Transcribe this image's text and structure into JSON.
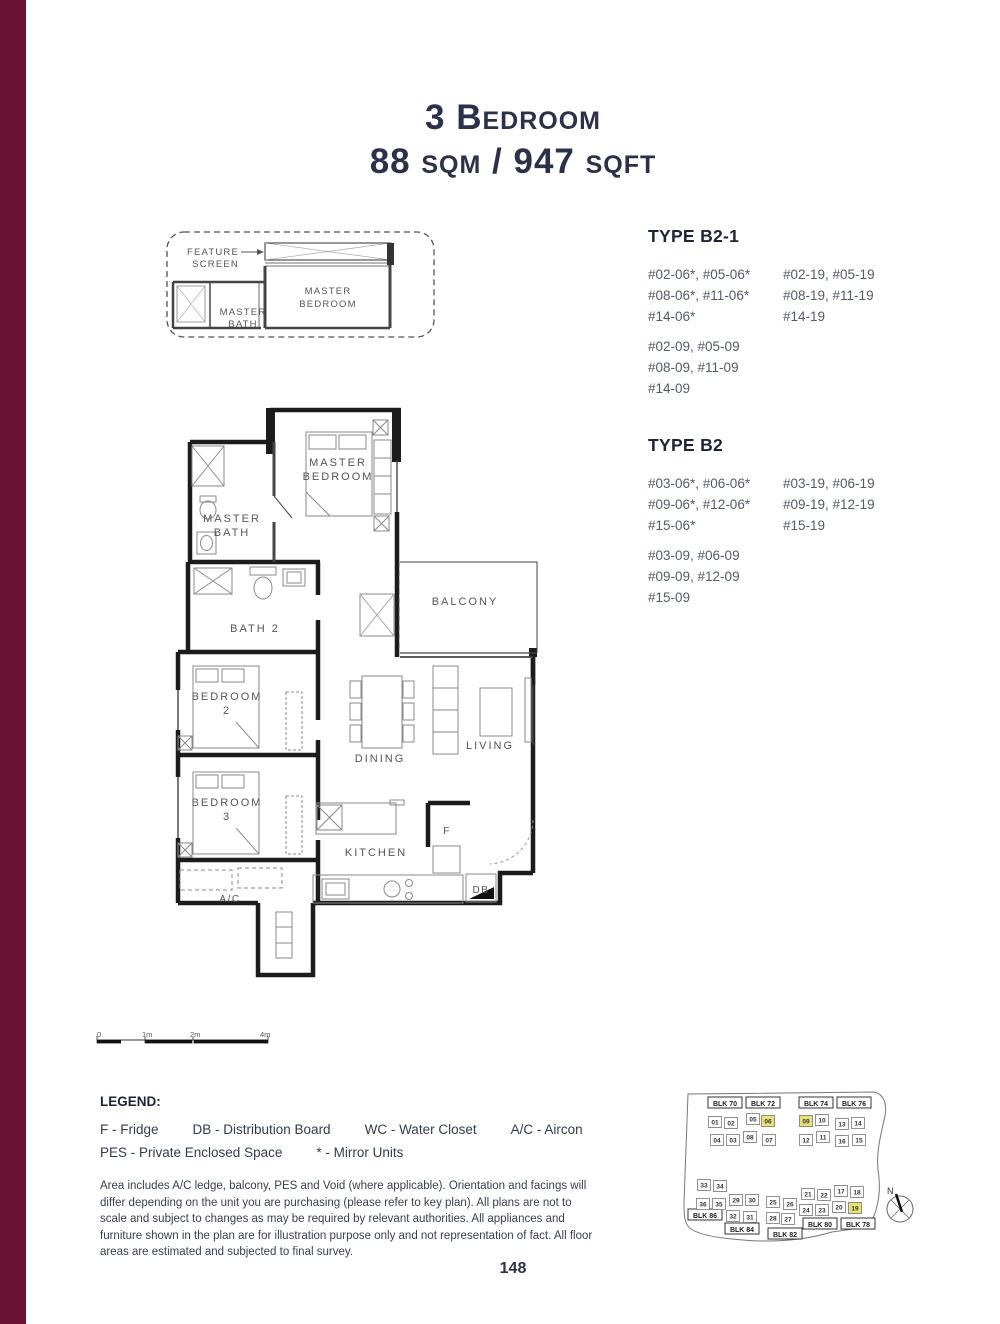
{
  "page": {
    "number": "148",
    "accent_color": "#6B1131",
    "highlight_color": "#e9e27a"
  },
  "title": {
    "line1": "3 Bedroom",
    "line2": "88 sqm / 947 sqft"
  },
  "types": [
    {
      "name": "TYPE B2-1",
      "c1a": [
        "#02-06*, #05-06*",
        "#08-06*, #11-06*",
        "#14-06*"
      ],
      "c2": [
        "#02-19, #05-19",
        "#08-19, #11-19",
        "#14-19"
      ],
      "c1b": [
        "#02-09, #05-09",
        "#08-09, #11-09",
        "#14-09"
      ]
    },
    {
      "name": "TYPE B2",
      "c1a": [
        "#03-06*, #06-06*",
        "#09-06*, #12-06*",
        "#15-06*"
      ],
      "c2": [
        "#03-19, #06-19",
        "#09-19, #12-19",
        "#15-19"
      ],
      "c1b": [
        "#03-09, #06-09",
        "#09-09, #12-09",
        "#15-09"
      ]
    }
  ],
  "inset": {
    "feature_screen_l1": "FEATURE",
    "feature_screen_l2": "SCREEN",
    "master_bedroom_l1": "MASTER",
    "master_bedroom_l2": "BEDROOM",
    "master_bath_l1": "MASTER",
    "master_bath_l2": "BATH"
  },
  "floorplan": {
    "master_bedroom_l1": "MASTER",
    "master_bedroom_l2": "BEDROOM",
    "master_bath_l1": "MASTER",
    "master_bath_l2": "BATH",
    "bath2": "BATH 2",
    "balcony": "BALCONY",
    "bedroom2_l1": "BEDROOM",
    "bedroom2_l2": "2",
    "bedroom3_l1": "BEDROOM",
    "bedroom3_l2": "3",
    "dining": "DINING",
    "living": "LIVING",
    "kitchen": "KITCHEN",
    "ac": "A/C",
    "fridge": "F",
    "db": "DB"
  },
  "scalebar": {
    "t0": "0",
    "t1": "1m",
    "t2": "2m",
    "t4": "4m"
  },
  "legend": {
    "title": "LEGEND:",
    "row1": [
      "F - Fridge",
      "DB - Distribution Board",
      "WC - Water Closet",
      "A/C - Aircon"
    ],
    "row2": [
      "PES - Private Enclosed Space",
      "* - Mirror Units"
    ]
  },
  "disclaimer": "Area includes A/C ledge, balcony, PES and Void (where applicable). Orientation and facings will differ depending on the unit you are purchasing (please refer to key plan). All plans are not to scale and subject to changes as may be required by relevant authorities. All appliances and furniture shown in the plan are for illustration purpose only and not representation of fact. All floor areas are estimated and subjected to final survey.",
  "keyplan": {
    "compass": "N",
    "blocks": [
      {
        "label": "BLK 70",
        "x": 53,
        "y": 21
      },
      {
        "label": "BLK 72",
        "x": 91,
        "y": 21
      },
      {
        "label": "BLK 74",
        "x": 144,
        "y": 21
      },
      {
        "label": "BLK 76",
        "x": 182,
        "y": 21
      },
      {
        "label": "BLK 86",
        "x": 33,
        "y": 133
      },
      {
        "label": "BLK 84",
        "x": 70,
        "y": 147
      },
      {
        "label": "BLK 82",
        "x": 113,
        "y": 152
      },
      {
        "label": "BLK 80",
        "x": 148,
        "y": 142
      },
      {
        "label": "BLK 78",
        "x": 186,
        "y": 142
      }
    ],
    "units": [
      {
        "n": "01",
        "x": 43,
        "y": 40
      },
      {
        "n": "02",
        "x": 59,
        "y": 41
      },
      {
        "n": "05",
        "x": 81,
        "y": 37
      },
      {
        "n": "06",
        "x": 96,
        "y": 39,
        "hl": true
      },
      {
        "n": "04",
        "x": 45,
        "y": 58
      },
      {
        "n": "03",
        "x": 61,
        "y": 58
      },
      {
        "n": "08",
        "x": 78,
        "y": 55
      },
      {
        "n": "07",
        "x": 97,
        "y": 58
      },
      {
        "n": "09",
        "x": 134,
        "y": 39,
        "hl": true
      },
      {
        "n": "10",
        "x": 150,
        "y": 38
      },
      {
        "n": "13",
        "x": 170,
        "y": 42
      },
      {
        "n": "14",
        "x": 186,
        "y": 41
      },
      {
        "n": "12",
        "x": 134,
        "y": 58
      },
      {
        "n": "11",
        "x": 151,
        "y": 55
      },
      {
        "n": "16",
        "x": 170,
        "y": 59
      },
      {
        "n": "15",
        "x": 187,
        "y": 58
      },
      {
        "n": "33",
        "x": 32,
        "y": 103
      },
      {
        "n": "34",
        "x": 48,
        "y": 104
      },
      {
        "n": "36",
        "x": 31,
        "y": 122
      },
      {
        "n": "35",
        "x": 47,
        "y": 122
      },
      {
        "n": "29",
        "x": 64,
        "y": 118
      },
      {
        "n": "30",
        "x": 80,
        "y": 118
      },
      {
        "n": "32",
        "x": 61,
        "y": 134
      },
      {
        "n": "31",
        "x": 78,
        "y": 135
      },
      {
        "n": "25",
        "x": 101,
        "y": 120
      },
      {
        "n": "26",
        "x": 118,
        "y": 122
      },
      {
        "n": "28",
        "x": 101,
        "y": 136
      },
      {
        "n": "27",
        "x": 116,
        "y": 137
      },
      {
        "n": "21",
        "x": 136,
        "y": 112
      },
      {
        "n": "22",
        "x": 152,
        "y": 113
      },
      {
        "n": "17",
        "x": 169,
        "y": 109
      },
      {
        "n": "18",
        "x": 185,
        "y": 110
      },
      {
        "n": "24",
        "x": 134,
        "y": 128
      },
      {
        "n": "23",
        "x": 150,
        "y": 128
      },
      {
        "n": "20",
        "x": 167,
        "y": 125
      },
      {
        "n": "19",
        "x": 183,
        "y": 126,
        "hl": true
      }
    ]
  }
}
